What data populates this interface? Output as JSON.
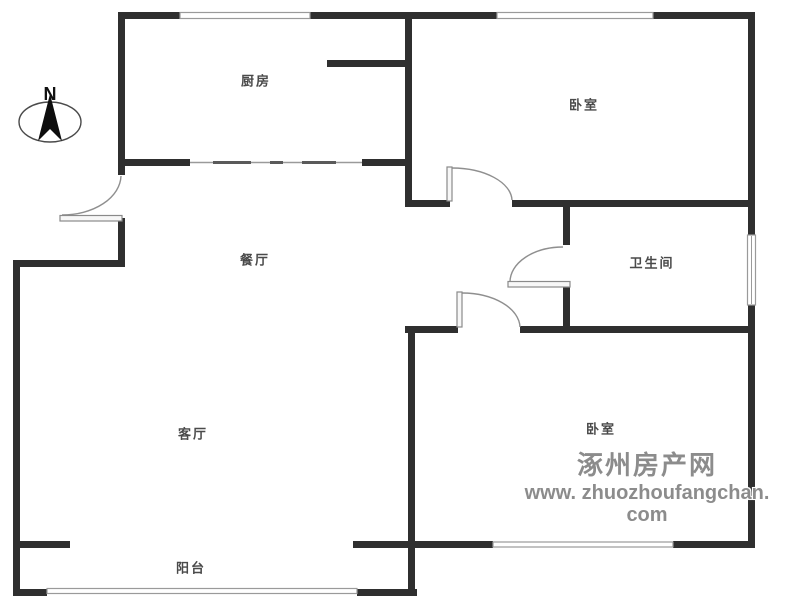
{
  "compass": {
    "north_label": "N"
  },
  "rooms": {
    "kitchen": {
      "label": "厨房"
    },
    "bedroom_top": {
      "label": "卧室"
    },
    "dining": {
      "label": "餐厅"
    },
    "bathroom": {
      "label": "卫生间"
    },
    "living": {
      "label": "客厅"
    },
    "bedroom_bottom": {
      "label": "卧室"
    },
    "balcony": {
      "label": "阳台"
    }
  },
  "watermark": {
    "site_name": "涿州房产网",
    "site_url": "www. zhuozhoufangchan. com"
  },
  "colors": {
    "wall": "#2f2f2f",
    "label": "#4a4a4a",
    "watermark": "#8c8c8c",
    "line": "#9a9a9a"
  }
}
